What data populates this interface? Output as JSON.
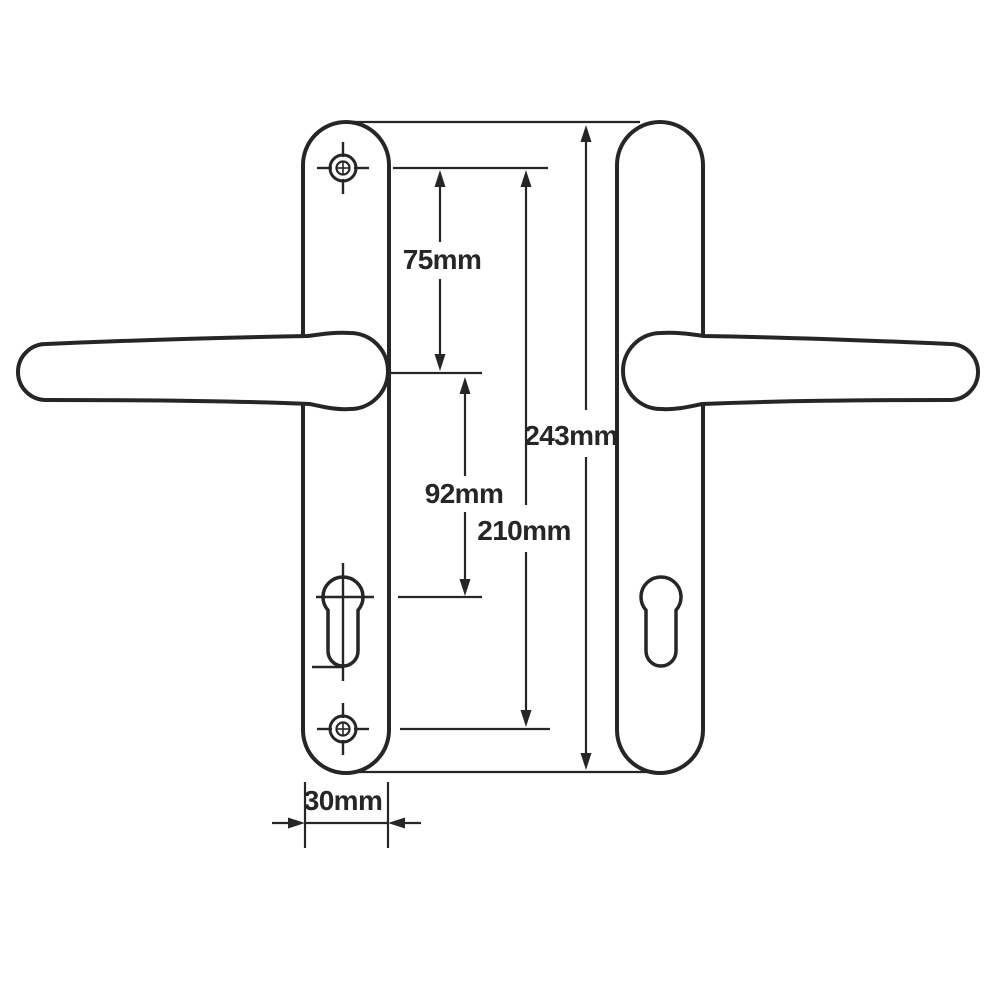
{
  "diagram": {
    "type": "technical-dimension-drawing",
    "subject": "lever door handle pair on long backplates",
    "dimensions": {
      "d75": {
        "label": "75mm",
        "value_mm": 75
      },
      "d92": {
        "label": "92mm",
        "value_mm": 92
      },
      "d210": {
        "label": "210mm",
        "value_mm": 210
      },
      "d243": {
        "label": "243mm",
        "value_mm": 243
      },
      "d30": {
        "label": "30mm",
        "value_mm": 30
      }
    }
  },
  "colors": {
    "ink": "#262626",
    "background": "#ffffff"
  }
}
